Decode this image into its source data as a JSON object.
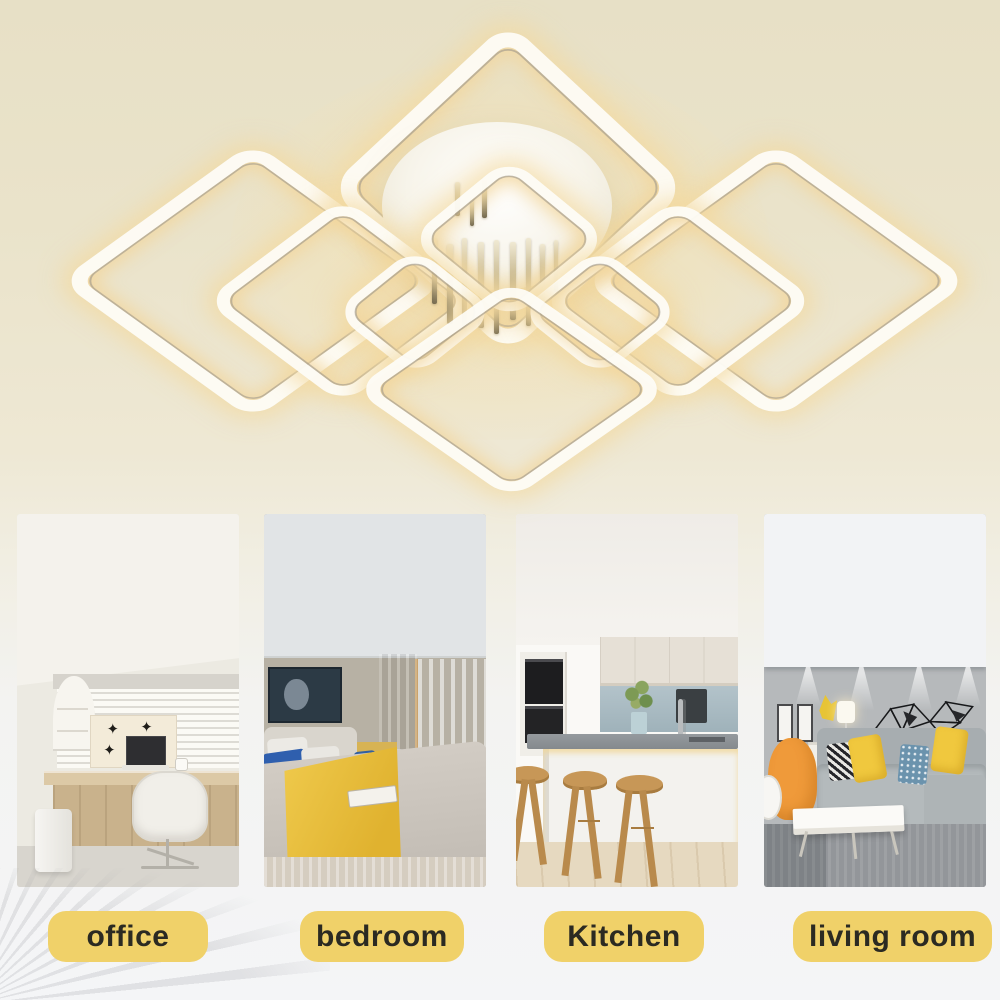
{
  "hero": {
    "description": "Modern LED ceiling lamp with layered glowing rounded-square rings and crystal rods",
    "background_color": "#e7e0c6"
  },
  "icons": {
    "diamond_cutout": "✦"
  },
  "badge_style": {
    "background": "#f0d169",
    "text_color": "#2b2a22"
  },
  "rooms": [
    {
      "id": "office",
      "label": "office",
      "photo": "home office with desk, laptop and white swivel chair"
    },
    {
      "id": "bedroom",
      "label": "bedroom",
      "photo": "bedroom with gray bedding, yellow throw and teal curtain"
    },
    {
      "id": "kitchen",
      "label": "Kitchen",
      "photo": "white kitchen island with three wooden bar stools"
    },
    {
      "id": "living-room",
      "label": "living room",
      "photo": "living room with gray sofa, yellow pillows and geometric wall art"
    }
  ]
}
